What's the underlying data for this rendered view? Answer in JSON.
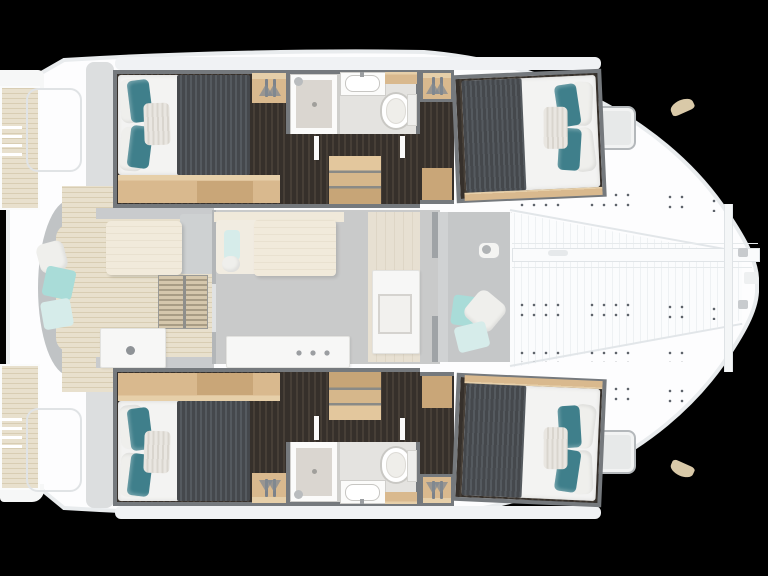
{
  "scene": {
    "type": "catamaran-floor-plan",
    "view": "top-down",
    "bow_side": "right",
    "stern_side": "left",
    "background": "#000000"
  },
  "plan": {
    "areas": [
      "aft-cockpit",
      "salon",
      "galley",
      "forward-cockpit",
      "trampoline",
      "port-hull",
      "starboard-hull",
      "swim-platforms",
      "foredeck"
    ],
    "per_hull": {
      "double_cabins": 2,
      "bathrooms": 1,
      "showers": 1,
      "toilets": 1,
      "wardrobes": 2,
      "companionway_steps": 1
    },
    "totals": {
      "double_cabins": 4,
      "bathrooms": 2,
      "deck_hatches": 2,
      "cockpit_tables": 1,
      "salon_tables": 1
    }
  },
  "icons": [
    "hanger-icon",
    "shower-head-icon",
    "toilet-icon",
    "sink-icon",
    "cooktop-icon",
    "winch-icon",
    "ladder-icon"
  ],
  "colors": {
    "black": "#000000",
    "hull_white": "#fdfdfe",
    "hull_outline": "#e9ecee",
    "deck_shadow": "#f0f2f4",
    "teak": "#e8e0cd",
    "teak_line": "#d8cdb3",
    "wood": "#d9b98e",
    "wood_light": "#e6cfa9",
    "wood_dark": "#c9a678",
    "floor_dark": "#36302b",
    "floor_dark2": "#473f37",
    "wall_gray": "#75797d",
    "blanket": "#45484c",
    "blanket_line": "#555a5f",
    "mattress": "#f3f3f2",
    "pillow_teal": "#3f7f8b",
    "pillow_aqua": "#a9dcd8",
    "pillow_pale": "#d6ecea",
    "pillow_white": "#efefec",
    "bath_floor": "#e4e3e0",
    "shower_tray": "#dad6d0",
    "fixture": "#fbfbfa",
    "fixture_line": "#cfcecb",
    "salon_floor": "#c9caca",
    "cockpit_floor": "#c5c7c8",
    "bench_gray": "#c0c3c5",
    "cream": "#f0e9da",
    "cream_dark": "#e7e0d2",
    "tramp": "#fbfcfd",
    "tramp_line": "#eef1f3",
    "dot": "#5f646b",
    "hatch_fill": "#e7e9e9",
    "hatch_border": "#b4b8bb",
    "tan": "#d9c9a8",
    "module": "#f7f7f6",
    "gray_deck": "#dcdedf"
  }
}
